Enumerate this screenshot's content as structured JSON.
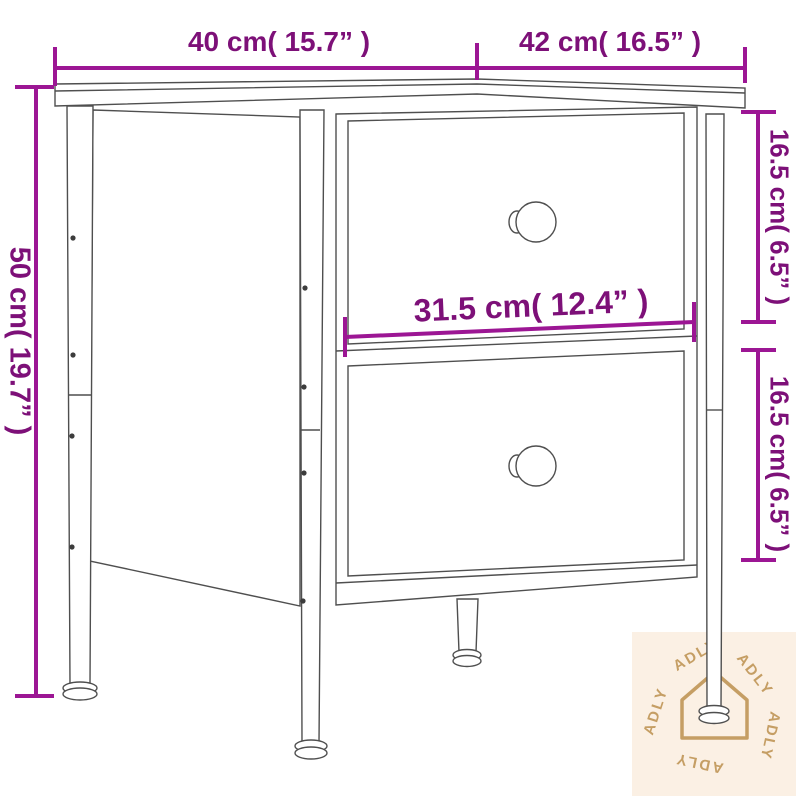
{
  "diagram": {
    "subject": "bedside-cabinet-with-two-drawers",
    "dimensions": {
      "top_width": "40 cm( 15.7” )",
      "top_depth": "42 cm( 16.5” )",
      "overall_height": "50 cm( 19.7” )",
      "upper_drawer_height": "16.5 cm( 6.5” )",
      "lower_drawer_height": "16.5 cm( 6.5” )",
      "drawer_width": "31.5 cm( 12.4” )"
    }
  },
  "watermark": {
    "brand": "ADLY",
    "icon": "house-icon",
    "background": "#fbf0e4",
    "accent": "#c59e64"
  },
  "colors": {
    "dimension_line": "#9c1694",
    "dimension_text": "#7d1078",
    "line_art": "#4f4f4f",
    "canvas": "#ffffff"
  }
}
